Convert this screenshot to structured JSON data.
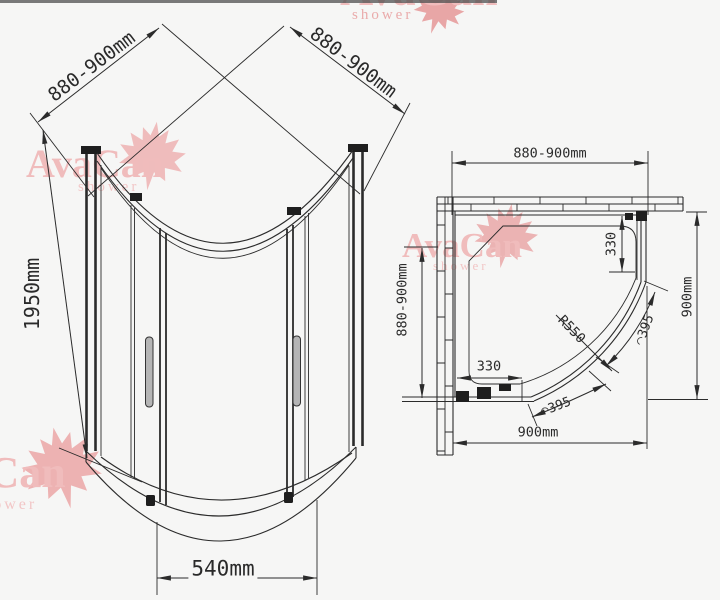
{
  "brand": {
    "name": "AvaCan",
    "tagline": "shower"
  },
  "iso_view": {
    "width_left": "880-900mm",
    "width_right": "880-900mm",
    "height": "1950mm",
    "door_width": "540mm"
  },
  "plan_view": {
    "width_top": "880-900mm",
    "depth_left": "880-900mm",
    "depth_right": "900mm",
    "width_bottom": "900mm",
    "panel_right": "330",
    "panel_bottom": "330",
    "radius": "R550",
    "arc_upper": "◠395",
    "arc_lower": "◠395"
  },
  "colors": {
    "linework": "#2b2b2b",
    "watermark_text": "#f0bcbc",
    "watermark_leaf": "#e9a6a6",
    "background": "#f6f6f5"
  }
}
